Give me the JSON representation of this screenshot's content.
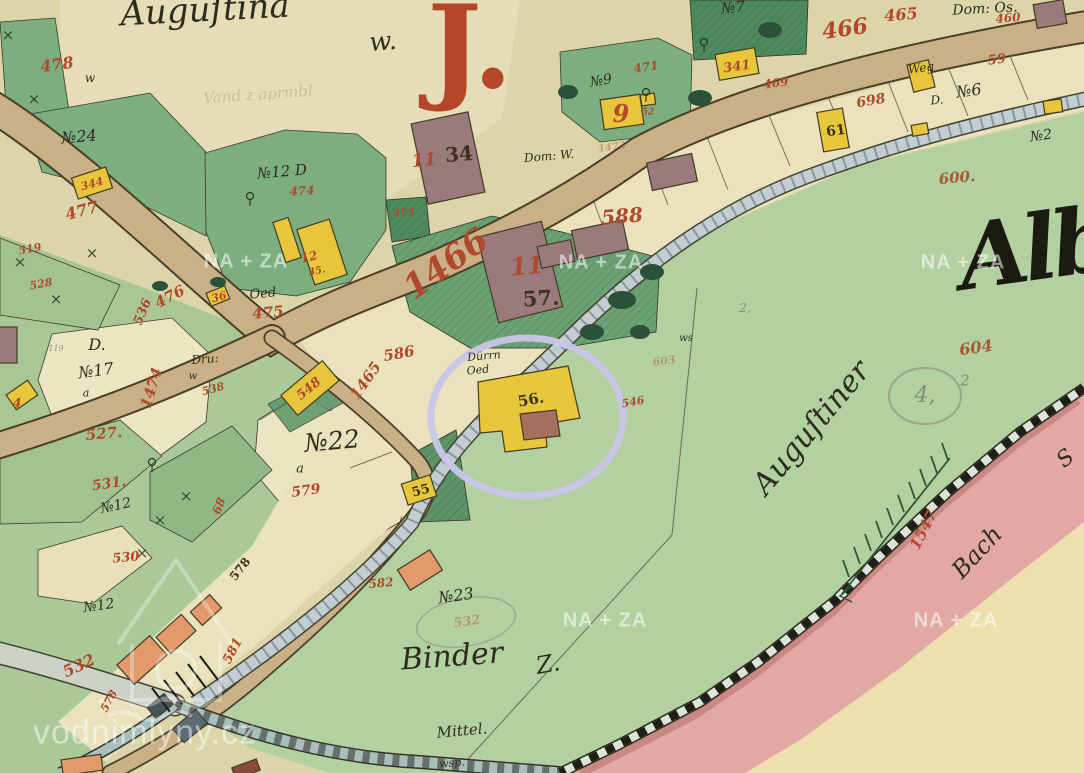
{
  "palette": {
    "parchment": "#dbd5a9",
    "cream": "#ece5c2",
    "cream_band": "#e9e2bd",
    "garden": "#e4ddb7",
    "field_green": "#b3d0a1",
    "parcel_green": "#7cae80",
    "dark_green": "#4f8a5f",
    "mid_green": "#6ba273",
    "road_tan": "#c9b086",
    "road_edge": "#4a3e28",
    "canal": "#c2ced2",
    "water_dark": "#a9bfbc",
    "gray_road": "#cdd2c8",
    "pink_band": "#e2a8a4",
    "pink_dark": "#c9847f",
    "cream_corner": "#eee0ae",
    "building_yellow": "#e7c63b",
    "building_brown": "#9b7a7e",
    "building_orange": "#e29a6a",
    "ink_red": "#b0492b",
    "ink_black": "#2e2c1e",
    "pencil": "#85836f",
    "highlight_purple": "#c9c5e8",
    "watermark_white": "#ffffff"
  },
  "watermarks": {
    "archive": "NA + ZA",
    "archive_positions": [
      [
        246,
        262
      ],
      [
        601,
        263
      ],
      [
        963,
        263
      ],
      [
        605,
        621
      ],
      [
        956,
        621
      ]
    ],
    "site": "vodnimlyny.cz",
    "site_position": [
      145,
      733
    ]
  },
  "highlight": {
    "shape": "ellipse",
    "around_label": "56."
  },
  "map_labels": [
    {
      "text": "Auguſtina",
      "x": 205,
      "y": 10,
      "size": 34,
      "rot": -3,
      "cls": "c"
    },
    {
      "text": "w.",
      "x": 383,
      "y": 42,
      "size": 26,
      "rot": -5,
      "cls": "c"
    },
    {
      "text": "J.",
      "x": 470,
      "y": 48,
      "size": 115,
      "rot": 0,
      "cls": "J"
    },
    {
      "text": "№7",
      "x": 733,
      "y": 8,
      "size": 15,
      "rot": -5,
      "cls": "c"
    },
    {
      "text": "Dom: Os.",
      "x": 985,
      "y": 9,
      "size": 14,
      "rot": -3,
      "cls": "c"
    },
    {
      "text": "465",
      "x": 901,
      "y": 15,
      "size": 16,
      "rot": -5,
      "cls": "r"
    },
    {
      "text": "466",
      "x": 845,
      "y": 29,
      "size": 22,
      "rot": -8,
      "cls": "r"
    },
    {
      "text": "460",
      "x": 1008,
      "y": 18,
      "size": 12,
      "rot": -5,
      "cls": "r"
    },
    {
      "text": "471",
      "x": 646,
      "y": 67,
      "size": 12,
      "rot": -8,
      "cls": "r"
    },
    {
      "text": "341",
      "x": 737,
      "y": 67,
      "size": 13,
      "rot": -8,
      "cls": "r"
    },
    {
      "text": "469",
      "x": 776,
      "y": 83,
      "size": 12,
      "rot": -8,
      "cls": "r"
    },
    {
      "text": "№9",
      "x": 601,
      "y": 81,
      "size": 14,
      "rot": -10,
      "cls": "c"
    },
    {
      "text": "9",
      "x": 621,
      "y": 114,
      "size": 24,
      "rot": 0,
      "cls": "r"
    },
    {
      "text": "52",
      "x": 648,
      "y": 113,
      "size": 9,
      "rot": 0,
      "cls": "r"
    },
    {
      "text": "Weg",
      "x": 921,
      "y": 68,
      "size": 12,
      "rot": -8,
      "cls": "c"
    },
    {
      "text": "59",
      "x": 997,
      "y": 60,
      "size": 13,
      "rot": -8,
      "cls": "r"
    },
    {
      "text": "D.",
      "x": 937,
      "y": 100,
      "size": 12,
      "rot": -5,
      "cls": "c"
    },
    {
      "text": "№6",
      "x": 969,
      "y": 91,
      "size": 16,
      "rot": -8,
      "cls": "c"
    },
    {
      "text": "698",
      "x": 871,
      "y": 101,
      "size": 14,
      "rot": -10,
      "cls": "r"
    },
    {
      "text": "61",
      "x": 836,
      "y": 131,
      "size": 14,
      "rot": -8,
      "cls": "k"
    },
    {
      "text": "№2",
      "x": 1041,
      "y": 136,
      "size": 14,
      "rot": -8,
      "cls": "c"
    },
    {
      "text": "600.",
      "x": 957,
      "y": 178,
      "size": 15,
      "rot": -5,
      "cls": "rb"
    },
    {
      "text": "11",
      "x": 424,
      "y": 161,
      "size": 18,
      "rot": -5,
      "cls": "r"
    },
    {
      "text": "34",
      "x": 459,
      "y": 154,
      "size": 20,
      "rot": -5,
      "cls": "k"
    },
    {
      "text": "Dom: W.",
      "x": 549,
      "y": 156,
      "size": 12,
      "rot": -5,
      "cls": "c"
    },
    {
      "text": "1472",
      "x": 612,
      "y": 148,
      "size": 10,
      "rot": -8,
      "cls": "rp"
    },
    {
      "text": "588",
      "x": 622,
      "y": 216,
      "size": 20,
      "rot": -5,
      "cls": "r"
    },
    {
      "text": "№24",
      "x": 79,
      "y": 137,
      "size": 16,
      "rot": -5,
      "cls": "c"
    },
    {
      "text": "478",
      "x": 57,
      "y": 65,
      "size": 16,
      "rot": -8,
      "cls": "r"
    },
    {
      "text": "w",
      "x": 90,
      "y": 78,
      "size": 12,
      "rot": 0,
      "cls": "c"
    },
    {
      "text": "344",
      "x": 92,
      "y": 184,
      "size": 11,
      "rot": -15,
      "cls": "r"
    },
    {
      "text": "477",
      "x": 82,
      "y": 211,
      "size": 16,
      "rot": -15,
      "cls": "r"
    },
    {
      "text": "№12 D",
      "x": 282,
      "y": 172,
      "size": 15,
      "rot": -5,
      "cls": "c"
    },
    {
      "text": "474",
      "x": 302,
      "y": 191,
      "size": 12,
      "rot": -3,
      "cls": "r"
    },
    {
      "text": "12",
      "x": 309,
      "y": 257,
      "size": 12,
      "rot": -12,
      "cls": "r"
    },
    {
      "text": "35.",
      "x": 317,
      "y": 272,
      "size": 10,
      "rot": -12,
      "cls": "r"
    },
    {
      "text": "473",
      "x": 404,
      "y": 214,
      "size": 10,
      "rot": -3,
      "cls": "r"
    },
    {
      "text": "1466",
      "x": 446,
      "y": 264,
      "size": 34,
      "rot": -36,
      "cls": "r"
    },
    {
      "text": "11",
      "x": 527,
      "y": 266,
      "size": 24,
      "rot": -5,
      "cls": "r"
    },
    {
      "text": "57.",
      "x": 541,
      "y": 298,
      "size": 21,
      "rot": -3,
      "cls": "k"
    },
    {
      "text": "476",
      "x": 170,
      "y": 297,
      "size": 15,
      "rot": -28,
      "cls": "r"
    },
    {
      "text": "36",
      "x": 219,
      "y": 297,
      "size": 11,
      "rot": -15,
      "cls": "r"
    },
    {
      "text": "Oed",
      "x": 263,
      "y": 294,
      "size": 13,
      "rot": -5,
      "cls": "c"
    },
    {
      "text": "475",
      "x": 268,
      "y": 313,
      "size": 15,
      "rot": -5,
      "cls": "r"
    },
    {
      "text": "519",
      "x": 30,
      "y": 249,
      "size": 11,
      "rot": -10,
      "cls": "r"
    },
    {
      "text": "528",
      "x": 41,
      "y": 284,
      "size": 11,
      "rot": -10,
      "cls": "r"
    },
    {
      "text": "536",
      "x": 143,
      "y": 312,
      "size": 13,
      "rot": -68,
      "cls": "r"
    },
    {
      "text": "D.",
      "x": 97,
      "y": 345,
      "size": 16,
      "rot": 0,
      "cls": "c"
    },
    {
      "text": "№17",
      "x": 96,
      "y": 371,
      "size": 16,
      "rot": -8,
      "cls": "c"
    },
    {
      "text": "119",
      "x": 56,
      "y": 349,
      "size": 8,
      "rot": 0,
      "cls": "p"
    },
    {
      "text": "Dru:",
      "x": 205,
      "y": 359,
      "size": 12,
      "rot": -5,
      "cls": "c"
    },
    {
      "text": "w",
      "x": 193,
      "y": 377,
      "size": 10,
      "rot": 0,
      "cls": "c"
    },
    {
      "text": "538",
      "x": 213,
      "y": 389,
      "size": 11,
      "rot": -15,
      "cls": "r"
    },
    {
      "text": "1474",
      "x": 152,
      "y": 388,
      "size": 15,
      "rot": -73,
      "cls": "r"
    },
    {
      "text": "586",
      "x": 399,
      "y": 354,
      "size": 15,
      "rot": -10,
      "cls": "r"
    },
    {
      "text": "Dürrn",
      "x": 484,
      "y": 356,
      "size": 11,
      "rot": -5,
      "cls": "c"
    },
    {
      "text": "Oed",
      "x": 478,
      "y": 370,
      "size": 11,
      "rot": -5,
      "cls": "c"
    },
    {
      "text": "1465",
      "x": 366,
      "y": 381,
      "size": 15,
      "rot": -55,
      "cls": "r"
    },
    {
      "text": "548",
      "x": 309,
      "y": 389,
      "size": 13,
      "rot": -40,
      "cls": "r"
    },
    {
      "text": "546",
      "x": 633,
      "y": 402,
      "size": 11,
      "rot": -10,
      "cls": "r"
    },
    {
      "text": "4",
      "x": 17,
      "y": 404,
      "size": 13,
      "rot": 0,
      "cls": "r"
    },
    {
      "text": "527.",
      "x": 104,
      "y": 434,
      "size": 15,
      "rot": -5,
      "cls": "r"
    },
    {
      "text": "№22",
      "x": 332,
      "y": 441,
      "size": 25,
      "rot": -5,
      "cls": "c"
    },
    {
      "text": "a",
      "x": 300,
      "y": 469,
      "size": 13,
      "rot": 0,
      "cls": "c"
    },
    {
      "text": "a",
      "x": 86,
      "y": 393,
      "size": 11,
      "rot": 0,
      "cls": "c"
    },
    {
      "text": "531.",
      "x": 109,
      "y": 484,
      "size": 14,
      "rot": -8,
      "cls": "r"
    },
    {
      "text": "№12",
      "x": 116,
      "y": 506,
      "size": 14,
      "rot": -12,
      "cls": "c"
    },
    {
      "text": "579",
      "x": 306,
      "y": 491,
      "size": 14,
      "rot": -8,
      "cls": "r"
    },
    {
      "text": "68",
      "x": 219,
      "y": 506,
      "size": 12,
      "rot": -68,
      "cls": "r"
    },
    {
      "text": "55",
      "x": 421,
      "y": 491,
      "size": 13,
      "rot": -15,
      "cls": "k"
    },
    {
      "text": "56.",
      "x": 531,
      "y": 400,
      "size": 15,
      "rot": -10,
      "cls": "k"
    },
    {
      "text": "530",
      "x": 126,
      "y": 558,
      "size": 13,
      "rot": -5,
      "cls": "r"
    },
    {
      "text": "578",
      "x": 240,
      "y": 569,
      "size": 12,
      "rot": -52,
      "cls": "k"
    },
    {
      "text": "581",
      "x": 233,
      "y": 651,
      "size": 13,
      "rot": -62,
      "cls": "r"
    },
    {
      "text": "532",
      "x": 79,
      "y": 666,
      "size": 16,
      "rot": -25,
      "cls": "r"
    },
    {
      "text": "№12",
      "x": 99,
      "y": 606,
      "size": 14,
      "rot": -8,
      "cls": "c"
    },
    {
      "text": "578",
      "x": 109,
      "y": 701,
      "size": 11,
      "rot": -62,
      "cls": "r"
    },
    {
      "text": "582",
      "x": 381,
      "y": 583,
      "size": 12,
      "rot": -5,
      "cls": "r"
    },
    {
      "text": "№23",
      "x": 456,
      "y": 596,
      "size": 16,
      "rot": -8,
      "cls": "c"
    },
    {
      "text": "532",
      "x": 467,
      "y": 622,
      "size": 13,
      "rot": -8,
      "cls": "rp"
    },
    {
      "text": "Binder",
      "x": 452,
      "y": 657,
      "size": 30,
      "rot": -4,
      "cls": "c"
    },
    {
      "text": "Z.",
      "x": 548,
      "y": 664,
      "size": 24,
      "rot": -10,
      "cls": "c"
    },
    {
      "text": "Mittel.",
      "x": 462,
      "y": 731,
      "size": 15,
      "rot": -5,
      "cls": "c"
    },
    {
      "text": "wsp.",
      "x": 452,
      "y": 763,
      "size": 11,
      "rot": -5,
      "cls": "c"
    },
    {
      "text": "Albe",
      "x": 1060,
      "y": 245,
      "size": 90,
      "rot": -8,
      "cls": "g"
    },
    {
      "text": "Auguſtiner",
      "x": 812,
      "y": 428,
      "size": 30,
      "rot": -50,
      "cls": "c"
    },
    {
      "text": "604",
      "x": 976,
      "y": 348,
      "size": 16,
      "rot": -8,
      "cls": "rb"
    },
    {
      "text": "4,",
      "x": 925,
      "y": 396,
      "size": 22,
      "rot": 0,
      "cls": "p"
    },
    {
      "text": "2",
      "x": 965,
      "y": 381,
      "size": 15,
      "rot": 0,
      "cls": "p"
    },
    {
      "text": "2,",
      "x": 745,
      "y": 308,
      "size": 12,
      "rot": 0,
      "cls": "p"
    },
    {
      "text": "ws",
      "x": 686,
      "y": 339,
      "size": 10,
      "rot": 0,
      "cls": "c"
    },
    {
      "text": "603",
      "x": 664,
      "y": 361,
      "size": 11,
      "rot": -8,
      "cls": "rp"
    },
    {
      "text": "Bach",
      "x": 977,
      "y": 552,
      "size": 24,
      "rot": -47,
      "cls": "c"
    },
    {
      "text": "S",
      "x": 1066,
      "y": 459,
      "size": 22,
      "rot": -40,
      "cls": "c"
    },
    {
      "text": "1547",
      "x": 924,
      "y": 530,
      "size": 15,
      "rot": -63,
      "cls": "r"
    },
    {
      "text": "Vand z aprmbl",
      "x": 258,
      "y": 95,
      "size": 15,
      "rot": -4,
      "cls": "p2"
    }
  ]
}
